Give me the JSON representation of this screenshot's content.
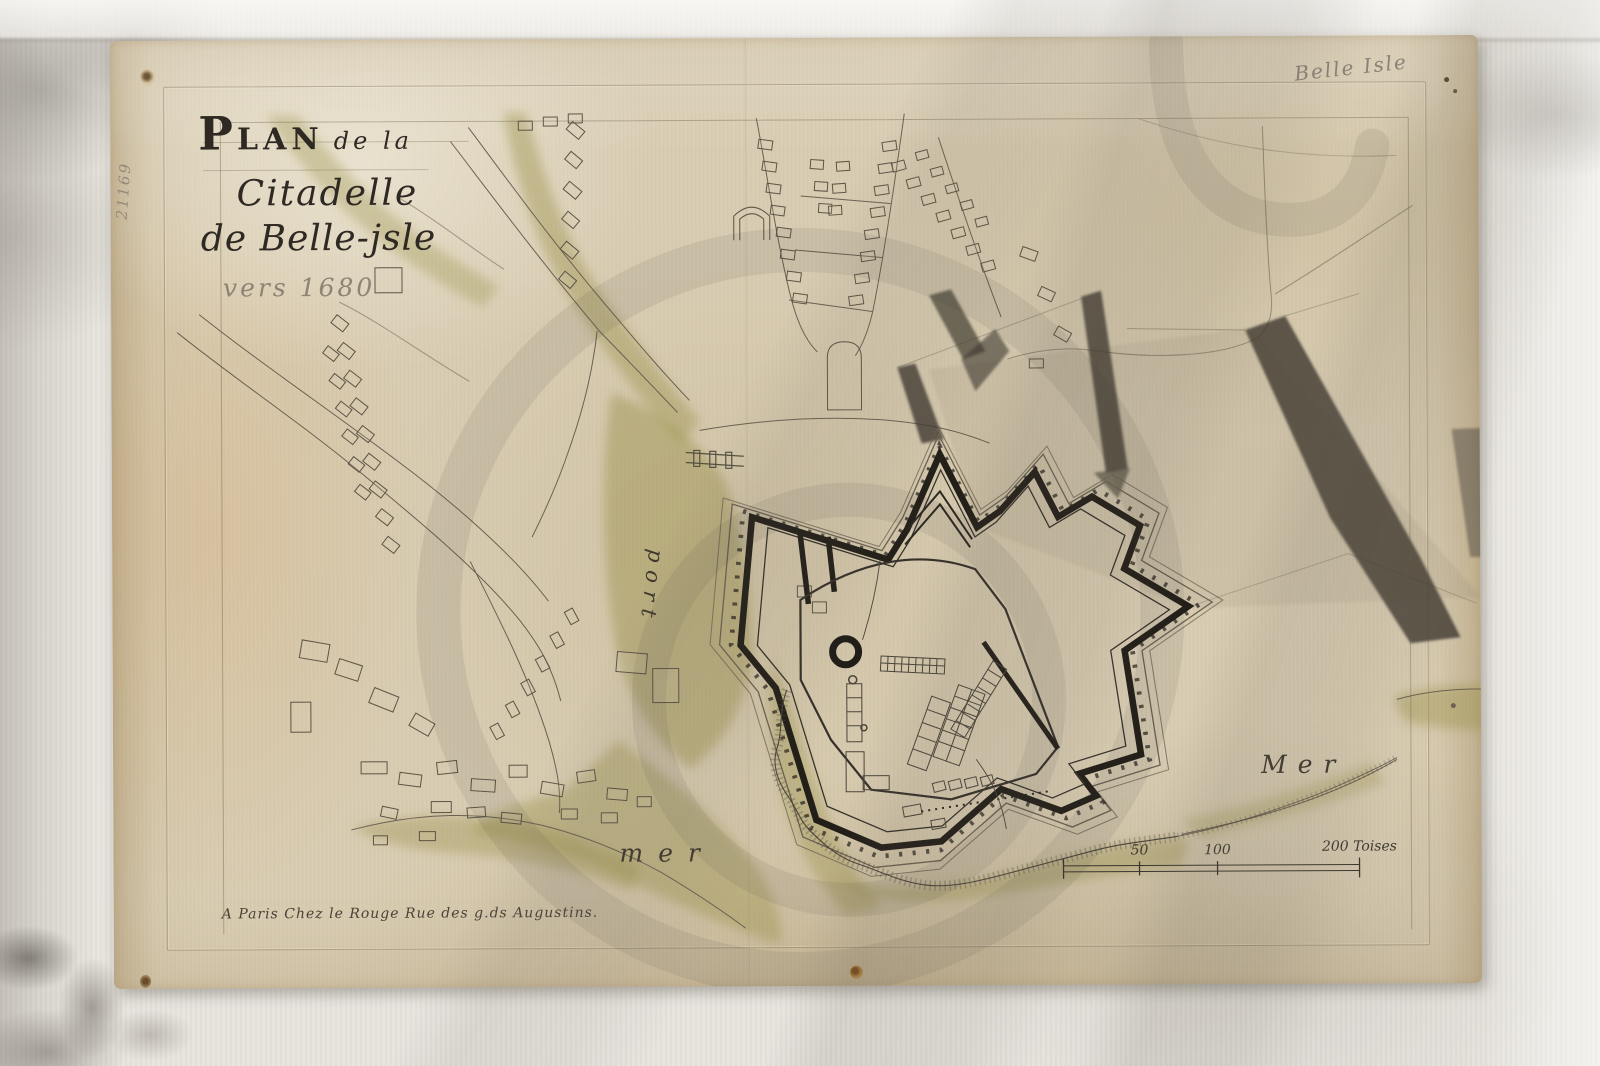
{
  "annotations": {
    "catalog_number": "21169",
    "pencil_note": "Belle Isle"
  },
  "map": {
    "title": {
      "word_initial": "P",
      "word_rest": "LAN",
      "subtitle": "de la",
      "line2": "Citadelle",
      "line3": "de Belle-jsle",
      "line4": "vers 1680"
    },
    "labels": {
      "port": "port",
      "mer_bottom": "mer",
      "mer_right": "Mer"
    },
    "imprint": "A Paris Chez le Rouge Rue des g.ds Augustins.",
    "scale": {
      "tick_50": "50",
      "tick_100": "100",
      "tick_200": "200 Toises"
    }
  }
}
